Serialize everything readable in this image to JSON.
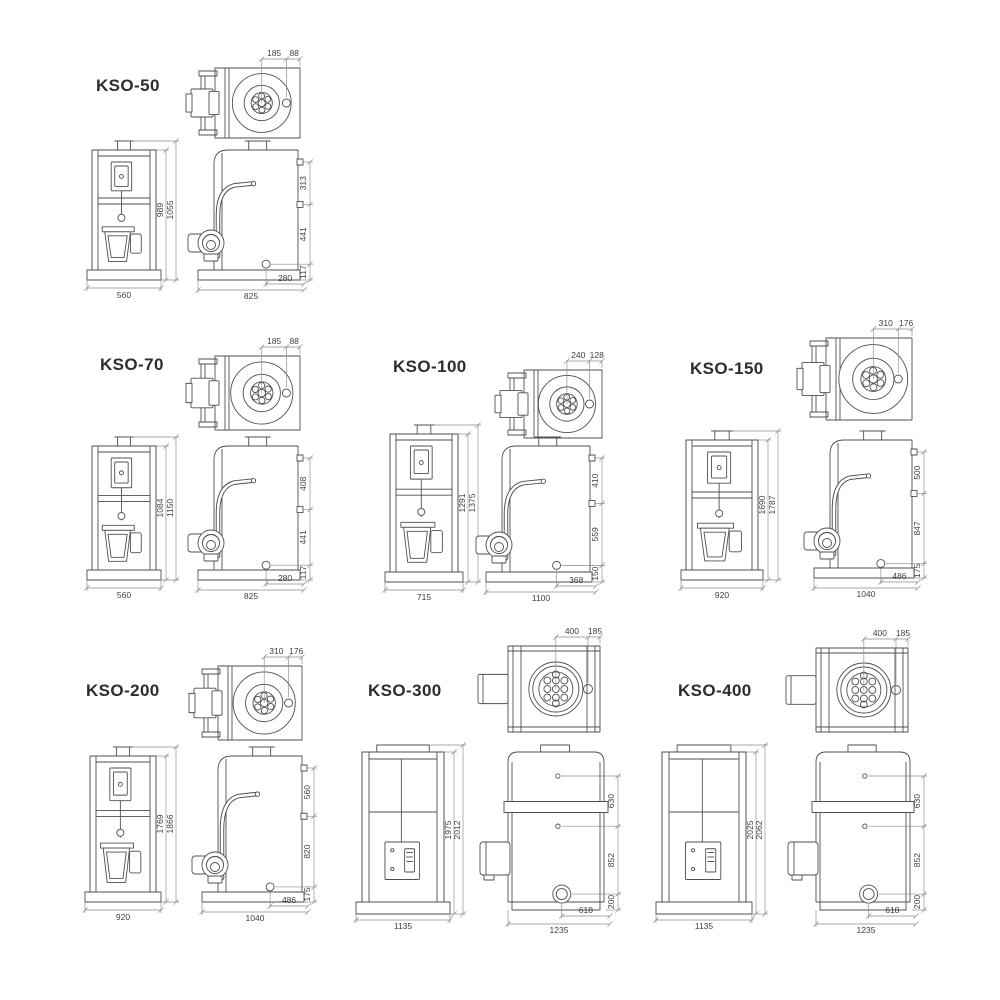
{
  "sheet": {
    "title": "KSO boiler dimensional drawings",
    "line_color": "#4f4f4f",
    "dim_line_color": "#8a8a8a",
    "dim_text_color": "#3f3f3f",
    "label_color": "#2d2d2d",
    "background": "#ffffff"
  },
  "models": [
    {
      "id": "kso-50",
      "label": "KSO-50",
      "top_dims": [
        "185",
        "88"
      ],
      "front": {
        "width": "560",
        "heights": [
          "989",
          "1055"
        ]
      },
      "side": {
        "rights": [
          "313",
          "441",
          "117"
        ],
        "bottom_inner": "280",
        "bottom_total": "825"
      }
    },
    {
      "id": "kso-70",
      "label": "KSO-70",
      "top_dims": [
        "185",
        "88"
      ],
      "front": {
        "width": "560",
        "heights": [
          "1084",
          "1150"
        ]
      },
      "side": {
        "rights": [
          "408",
          "441",
          "117"
        ],
        "bottom_inner": "280",
        "bottom_total": "825"
      }
    },
    {
      "id": "kso-100",
      "label": "KSO-100",
      "top_dims": [
        "240",
        "128"
      ],
      "front": {
        "width": "715",
        "heights": [
          "1291",
          "1375"
        ]
      },
      "side": {
        "rights": [
          "410",
          "559",
          "150"
        ],
        "bottom_inner": "368",
        "bottom_total": "1100"
      }
    },
    {
      "id": "kso-150",
      "label": "KSO-150",
      "top_dims": [
        "310",
        "176"
      ],
      "front": {
        "width": "920",
        "heights": [
          "1690",
          "1787"
        ]
      },
      "side": {
        "rights": [
          "500",
          "847",
          "175"
        ],
        "bottom_inner": "486",
        "bottom_total": "1040"
      }
    },
    {
      "id": "kso-200",
      "label": "KSO-200",
      "top_dims": [
        "310",
        "176"
      ],
      "front": {
        "width": "920",
        "heights": [
          "1769",
          "1866"
        ]
      },
      "side": {
        "rights": [
          "560",
          "820",
          "175"
        ],
        "bottom_inner": "486",
        "bottom_total": "1040"
      }
    },
    {
      "id": "kso-300",
      "label": "KSO-300",
      "top_dims": [
        "400",
        "185"
      ],
      "front": {
        "width": "1135",
        "heights": [
          "1975",
          "2012"
        ]
      },
      "side": {
        "rights": [
          "630",
          "852",
          "200"
        ],
        "bottom_inner": "618",
        "bottom_total": "1235"
      }
    },
    {
      "id": "kso-400",
      "label": "KSO-400",
      "top_dims": [
        "400",
        "185"
      ],
      "front": {
        "width": "1135",
        "heights": [
          "2025",
          "2062"
        ]
      },
      "side": {
        "rights": [
          "630",
          "852",
          "200"
        ],
        "bottom_inner": "618",
        "bottom_total": "1235"
      }
    }
  ]
}
